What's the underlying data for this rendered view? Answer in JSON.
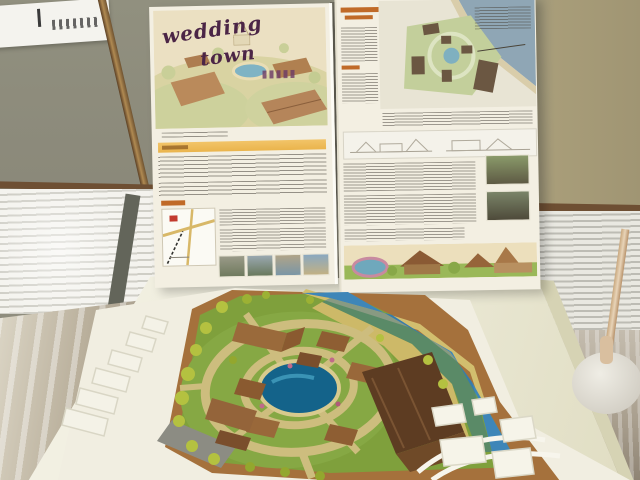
{
  "scene": {
    "description": "Exhibition photo: two presentation boards for a wedding-town design above a physical architectural site model on a white table",
    "poster_left": {
      "title_line1": "wedding",
      "title_line2": "town"
    },
    "palette": {
      "wall": "#8f8d7e",
      "wall_right": "#a89d79",
      "blinds": "#f4f3ee",
      "floor": "#b9af9b",
      "table": "#ece9d8",
      "poster_paper": "#f3efe2",
      "title_ink": "#4b2546",
      "section_bar": "#eab44c",
      "model_grass": "#7fa03c",
      "model_path": "#cdbd7e",
      "model_pond": "#14638a",
      "model_river": "#3e86b8",
      "model_roof": "#8e5e33",
      "model_roof_dark": "#5d3c22",
      "model_cork": "#a5713c",
      "massing_white": "#f4f2e7"
    }
  }
}
